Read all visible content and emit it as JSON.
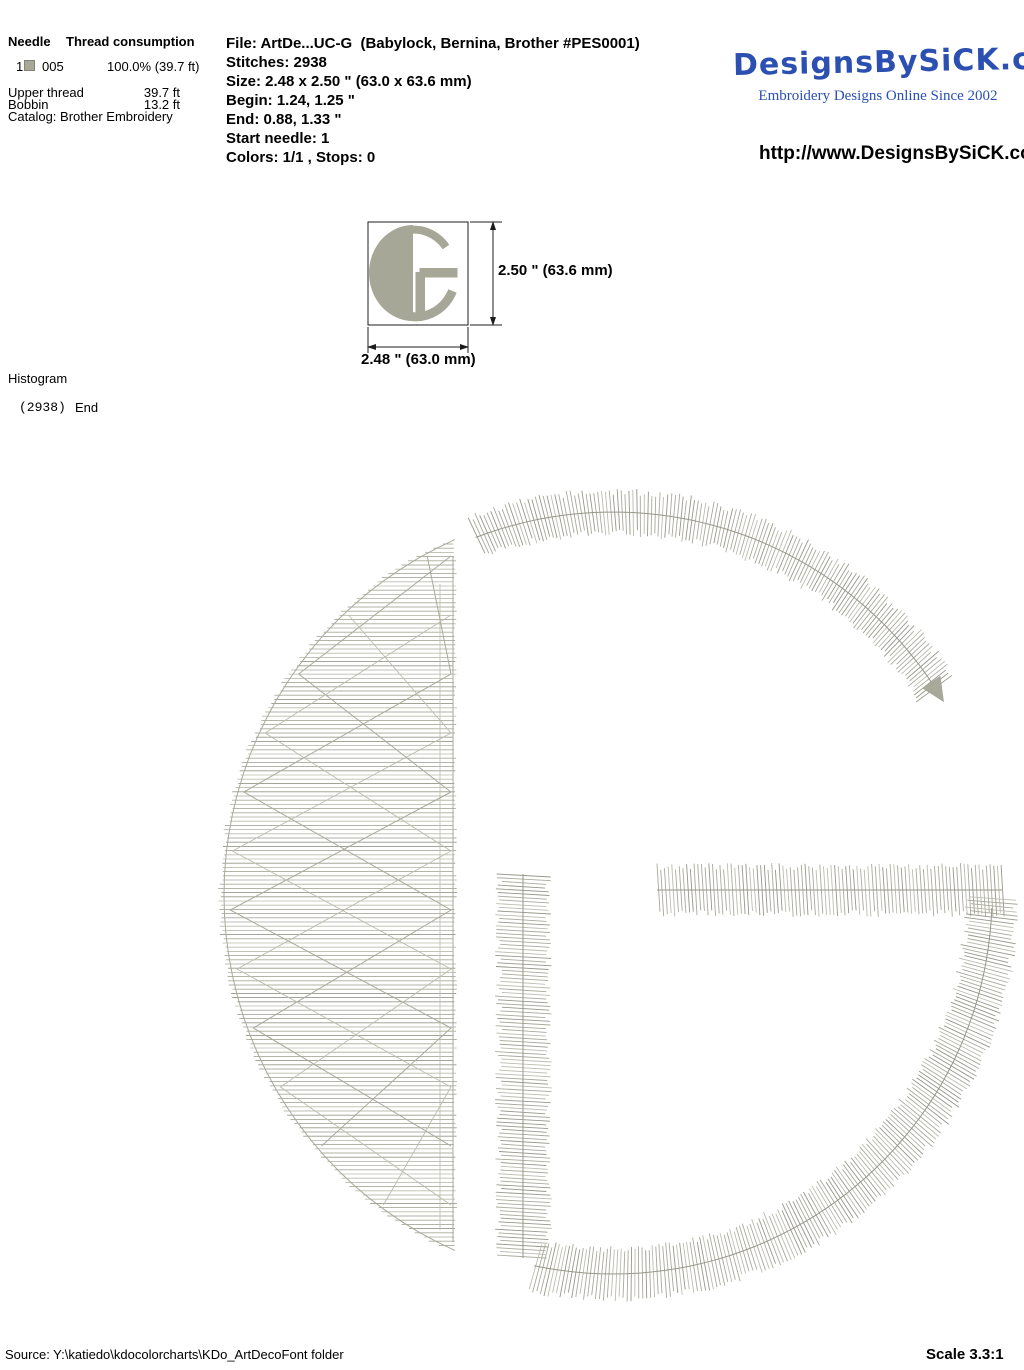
{
  "colors": {
    "stitch": "#a9a99b",
    "stitch_light": "#bcbcae",
    "stitch_dark": "#97978a",
    "thumbnail_glyph": "#a7a797",
    "needle_swatch": "#a8a896",
    "logo_blue": "#2b50b2"
  },
  "needle_table": {
    "col_needle": "Needle",
    "col_thread_consumption": "Thread consumption",
    "row": {
      "needle_number": "1",
      "thread_code": "005",
      "consumption": "100.0% (39.7 ft)"
    },
    "upper_thread_label": "Upper thread",
    "upper_thread_value": "39.7 ft",
    "bobbin_label": "Bobbin",
    "bobbin_value": "13.2 ft",
    "catalog": "Catalog: Brother Embroidery"
  },
  "file_info": {
    "file_line": "File: ArtDe...UC-G  (Babylock, Bernina, Brother #PES0001)",
    "stitches_line": "Stitches: 2938",
    "size_line": "Size: 2.48 x 2.50 \" (63.0 x 63.6 mm)",
    "begin_line": "Begin: 1.24, 1.25 \"",
    "end_line": "End: 0.88, 1.33 \"",
    "start_needle_line": "Start needle: 1",
    "colors_line": "Colors: 1/1 , Stops: 0"
  },
  "brand": {
    "logo_text": "DesignsBySiCK.com",
    "tagline": "Embroidery Designs Online Since 2002",
    "url": "http://www.DesignsBySiCK.com"
  },
  "preview": {
    "height_label": "2.50 \" (63.6 mm)",
    "width_label": "2.48 \" (63.0 mm)"
  },
  "histogram": {
    "title": "Histogram",
    "stitch_count": "(2938)",
    "end_label": "End"
  },
  "footer": {
    "source": "Source: Y:\\katiedo\\kdocolorcharts\\KDo_ArtDecoFont folder",
    "scale": "Scale 3.3:1"
  }
}
